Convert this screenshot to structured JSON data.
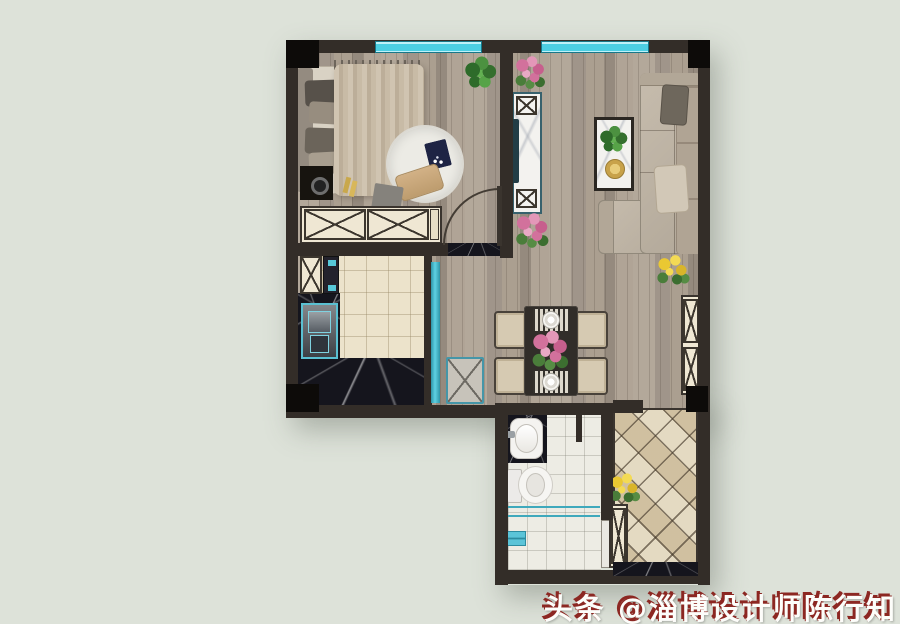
{
  "image": {
    "type": "interior-design-floor-plan-rendering",
    "view": "top-down"
  },
  "watermark": {
    "text": "头条 @淄博设计师陈行知",
    "platform": "头条",
    "account": "@淄博设计师陈行知",
    "text_color": "#fdfdfa",
    "shadow_color": "#8c2722"
  },
  "palette": {
    "background": "#dde2d9",
    "wall": "#332d28",
    "pillar": "#0d0b09",
    "wood_floor": "#a89d90",
    "kitchen_tile": "#ece3cb",
    "bathroom_tile": "#edece4",
    "balcony_tile": "#e0d5bc",
    "dark_marble": "#15151d",
    "window_glass": "#4ccfe3",
    "teal_accent": "#45bdd0",
    "sofa_beige": "#c0b6a7",
    "cabinet_cream": "#f0e8d4",
    "table_dark": "#312d29",
    "plant_green": "#3c7a33",
    "flower_pink": "#d2719c",
    "flower_yellow": "#eac832"
  },
  "rooms": {
    "bedroom": {
      "furniture": [
        "double-bed",
        "pillows",
        "nightstand",
        "round-rug",
        "laptop",
        "floor-pillow",
        "wardrobe",
        "green-plant"
      ]
    },
    "living_room": {
      "furniture": [
        "l-shaped-sofa",
        "throw-pillows",
        "coffee-table",
        "tv-cabinet",
        "pink-flower-pots",
        "yellow-flower-pot"
      ]
    },
    "kitchen": {
      "furniture": [
        "l-shaped-black-marble-counter",
        "sink",
        "tall-unit",
        "small-cabinet",
        "glass-sliding-door"
      ]
    },
    "dining_area": {
      "furniture": [
        "dark-dining-table",
        "four-chairs",
        "two-place-settings",
        "flower-centerpiece",
        "teal-stool",
        "entry-cabinet"
      ]
    },
    "bathroom": {
      "furniture": [
        "washbasin-on-marble-counter",
        "toilet",
        "shower-glass-screen",
        "floor-drain",
        "sliding-door"
      ]
    },
    "balcony": {
      "furniture": [
        "diamond-tile-floor",
        "slim-storage-cabinet",
        "yellow-flower-pot",
        "marble-threshold"
      ]
    }
  }
}
